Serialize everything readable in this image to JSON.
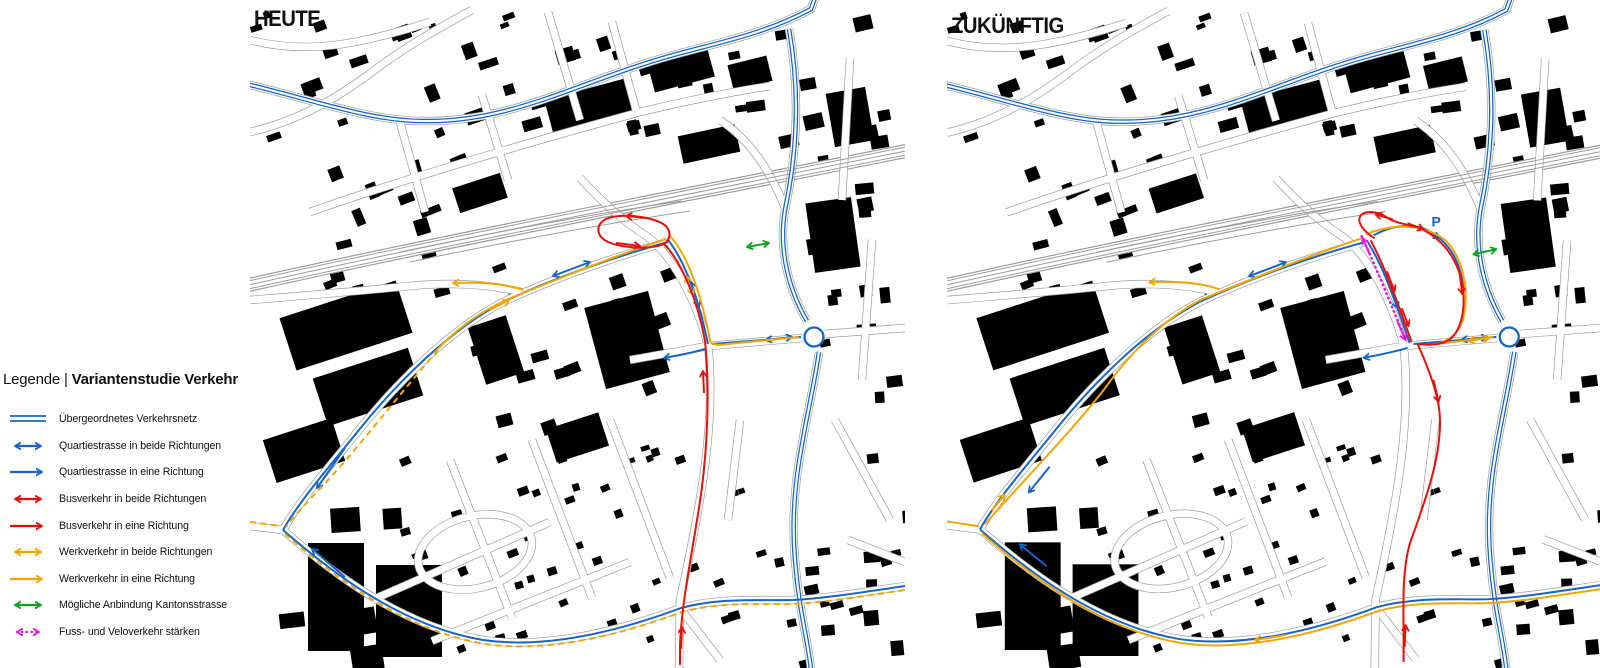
{
  "legend": {
    "title_prefix": "Legende | ",
    "title_bold": "Variantenstudie Verkehr",
    "items": [
      {
        "label": "Übergeordnetes Verkehrsnetz",
        "type": "double-line",
        "color_key": "network_blue"
      },
      {
        "label": "Quartiestrasse in beide Richtungen",
        "type": "double-arrow",
        "color_key": "quartier_blue"
      },
      {
        "label": "Quartiestrasse in eine Richtung",
        "type": "single-arrow",
        "color_key": "quartier_blue"
      },
      {
        "label": "Busverkehr in beide Richtungen",
        "type": "double-arrow",
        "color_key": "bus_red"
      },
      {
        "label": "Busverkehr in eine Richtung",
        "type": "single-arrow",
        "color_key": "bus_red"
      },
      {
        "label": "Werkverkehr in beide Richtungen",
        "type": "double-arrow",
        "color_key": "werk_yellow"
      },
      {
        "label": "Werkverkehr in eine Richtung",
        "type": "single-arrow",
        "color_key": "werk_yellow"
      },
      {
        "label": "Mögliche Anbindung Kantonsstrasse",
        "type": "double-arrow",
        "color_key": "kantons_green"
      },
      {
        "label": "Fuss- und Veloverkehr stärken",
        "type": "dotted-double-arrow",
        "color_key": "velo_magenta"
      }
    ]
  },
  "maps": {
    "left": {
      "title": "HEUTE"
    },
    "right": {
      "title": "ZUKÜNFTIG",
      "parking_label": "P"
    }
  },
  "colors": {
    "network_blue": "#1565c8",
    "quartier_blue": "#1565c8",
    "bus_red": "#e81109",
    "werk_yellow": "#f5a500",
    "kantons_green": "#0ea31c",
    "velo_magenta": "#e816d6",
    "building_black": "#000000",
    "road_gray": "#9c9c9c"
  }
}
